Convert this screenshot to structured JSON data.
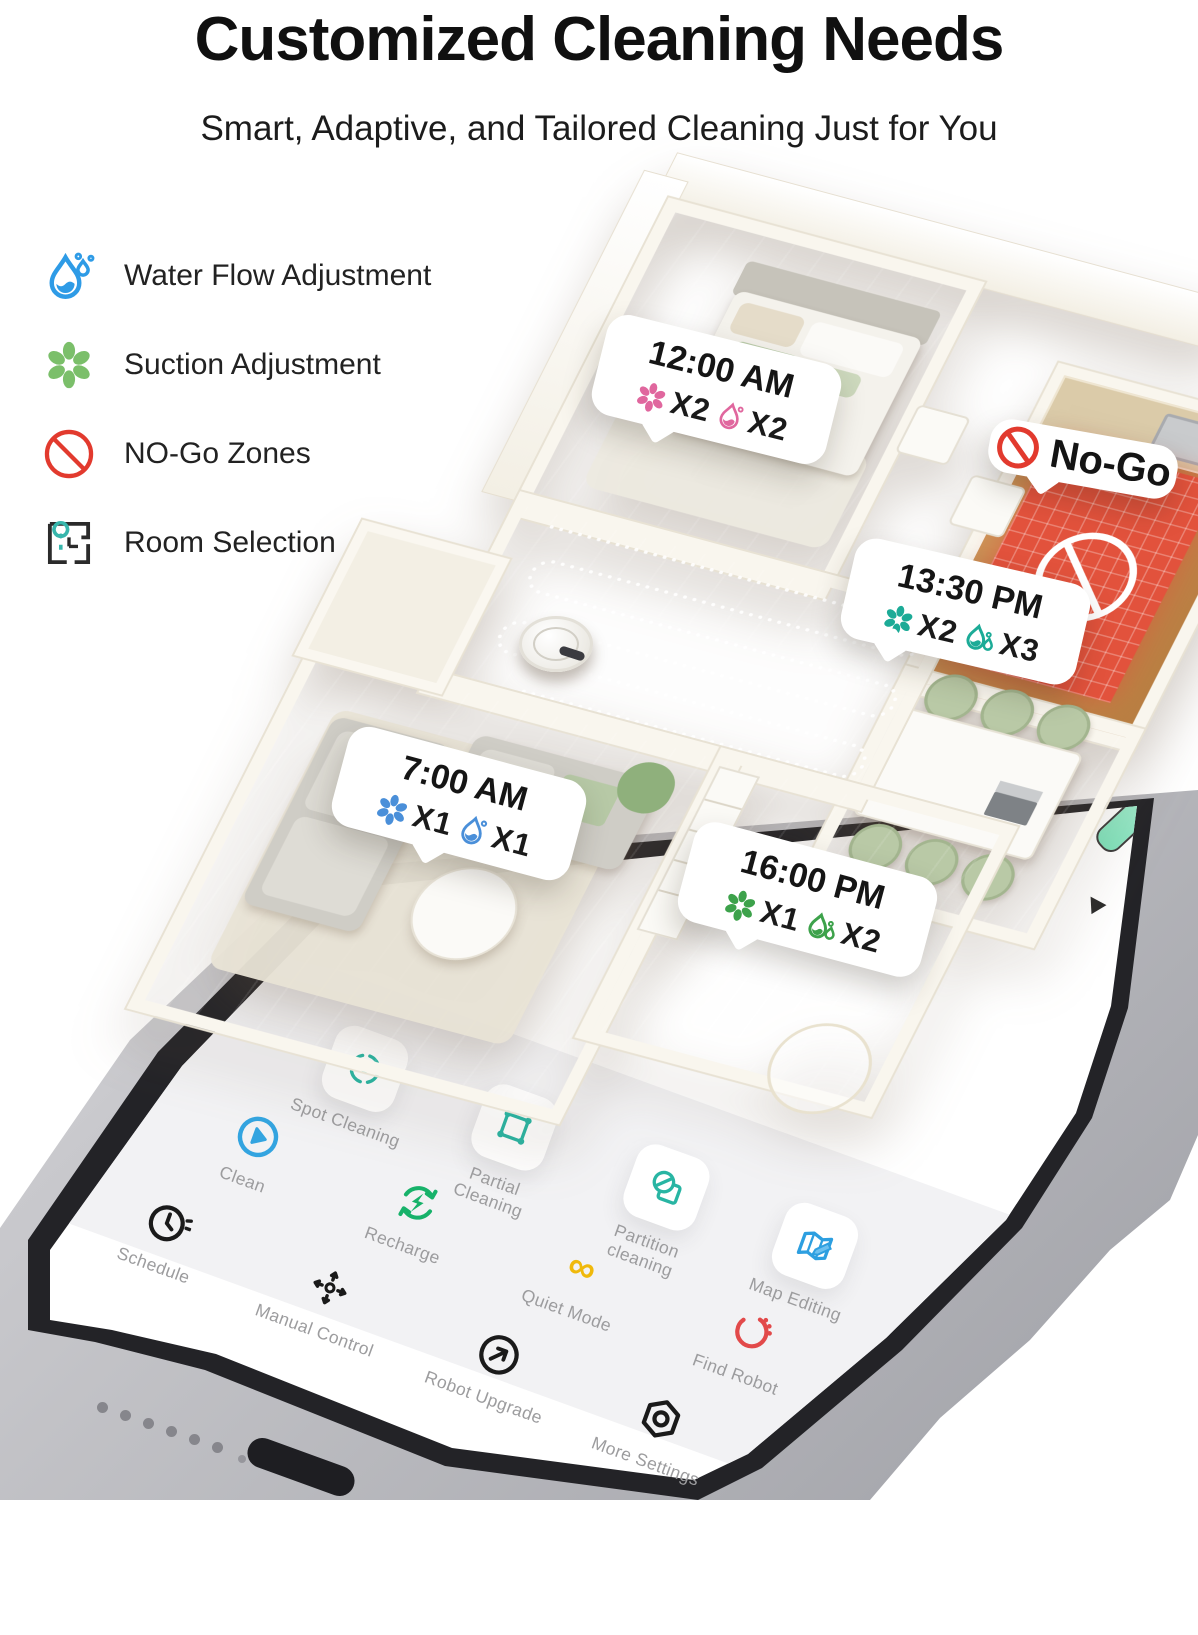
{
  "header": {
    "title": "Customized Cleaning Needs",
    "subtitle": "Smart, Adaptive, and Tailored Cleaning Just for You"
  },
  "legend": {
    "items": [
      {
        "label": "Water Flow Adjustment",
        "icon": "water-drop-icon",
        "color": "#2e9be6"
      },
      {
        "label": "Suction Adjustment",
        "icon": "suction-fan-icon",
        "color": "#7bbf6a"
      },
      {
        "label": "NO-Go Zones",
        "icon": "no-entry-icon",
        "color": "#e23a2e"
      },
      {
        "label": "Room Selection",
        "icon": "floorplan-pin-icon",
        "color": "#2b2b2b"
      }
    ]
  },
  "floorplan": {
    "callouts": [
      {
        "room": "bedroom",
        "time": "12:00 AM",
        "suction": "X2",
        "water": "X2",
        "color": "#e0679e"
      },
      {
        "room": "kitchen",
        "label": "No-Go",
        "color": "#e23a2e"
      },
      {
        "room": "dining",
        "time": "13:30 PM",
        "suction": "X2",
        "water": "X3",
        "color": "#1cab97"
      },
      {
        "room": "living",
        "time": "7:00 AM",
        "suction": "X1",
        "water": "X1",
        "color": "#4a8fd9"
      },
      {
        "room": "hallway",
        "time": "16:00 PM",
        "suction": "X1",
        "water": "X2",
        "color": "#3da24b"
      }
    ],
    "no_go_zone_color": "#e2523c",
    "floor_color": "#c98f52"
  },
  "phone": {
    "apps": [
      {
        "label": "Spot Cleaning",
        "icon": "spot-cleaning-icon",
        "color": "#28b5a3"
      },
      {
        "label": "Partial Cleaning",
        "icon": "partial-cleaning-icon",
        "color": "#28b5a3"
      },
      {
        "label": "Partition cleaning",
        "icon": "partition-cleaning-icon",
        "color": "#28b5a3"
      },
      {
        "label": "Map Editing",
        "icon": "map-editing-icon",
        "color": "#2d9fe0"
      },
      {
        "label": "Clean",
        "icon": "clean-play-icon",
        "color": "#33a4e0"
      },
      {
        "label": "Recharge",
        "icon": "recharge-icon",
        "color": "#17b26a"
      },
      {
        "label": "Quiet Mode",
        "icon": "quiet-mode-icon",
        "color": "#f0b90b"
      },
      {
        "label": "Find Robot",
        "icon": "find-robot-icon",
        "color": "#e24a4a"
      },
      {
        "label": "Schedule",
        "icon": "schedule-clock-icon",
        "color": "#1a1a1a"
      },
      {
        "label": "Manual Control",
        "icon": "manual-control-icon",
        "color": "#1a1a1a"
      },
      {
        "label": "Robot Upgrade",
        "icon": "robot-upgrade-icon",
        "color": "#1a1a1a"
      },
      {
        "label": "More Settings",
        "icon": "more-settings-icon",
        "color": "#1a1a1a"
      }
    ]
  }
}
